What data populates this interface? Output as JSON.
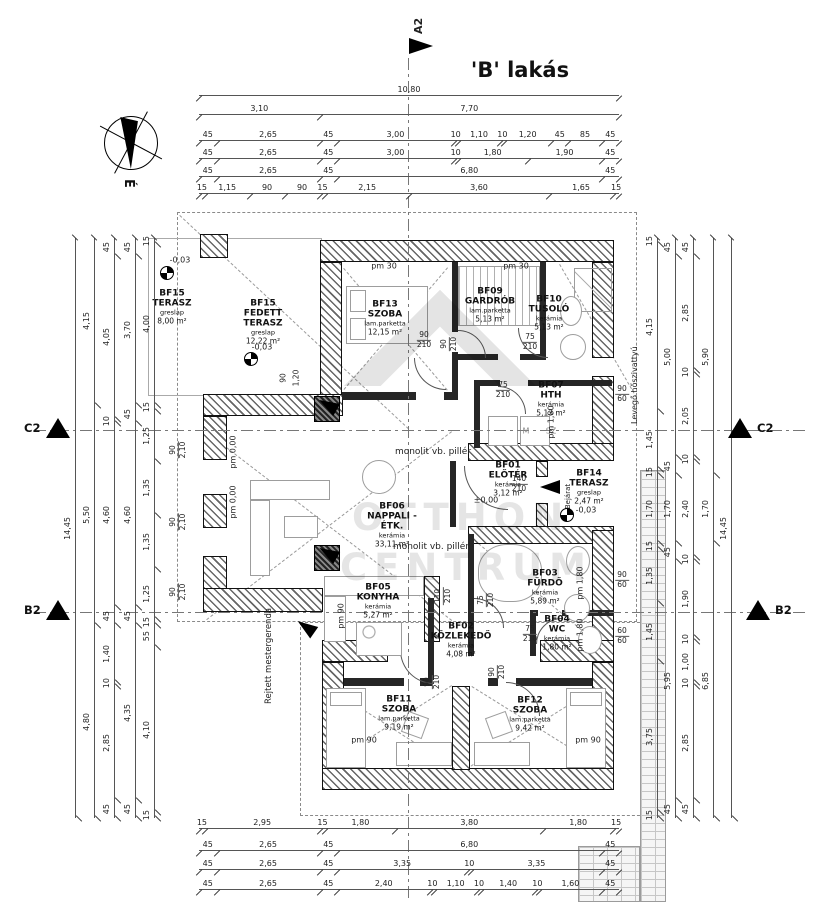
{
  "title": "'B' lakás",
  "markers": {
    "a2": "A2",
    "c2": "C2",
    "b2": "B2"
  },
  "compass": {
    "north_label": "É"
  },
  "watermark": {
    "line1": "OTTHON",
    "line2": "CENTRUM"
  },
  "rooms": [
    {
      "id": "BF15",
      "name": "TERASZ",
      "finish": "greslap",
      "area": "8,00 m²"
    },
    {
      "id": "BF15",
      "name": "FEDETT TERASZ",
      "finish": "greslap",
      "area": "12,22 m²"
    },
    {
      "id": "BF13",
      "name": "SZOBA",
      "finish": "lam.parketta",
      "area": "12,15 m²"
    },
    {
      "id": "BF09",
      "name": "GARDRÓB",
      "finish": "lam.parketta",
      "area": "5,13 m²"
    },
    {
      "id": "BF10",
      "name": "TUSOLÓ",
      "finish": "kerámia",
      "area": "5,13 m²"
    },
    {
      "id": "BF07",
      "name": "HTH",
      "finish": "kerámia",
      "area": "5,13 m²"
    },
    {
      "id": "BF01",
      "name": "ELŐTÉR",
      "finish": "kerámia",
      "area": "3,12 m²"
    },
    {
      "id": "BF14",
      "name": "TERASZ",
      "finish": "greslap",
      "area": "2,47 m²"
    },
    {
      "id": "BF06",
      "name": "NAPPALI - ÉTK.",
      "finish": "kerámia",
      "area": "33,11 m²"
    },
    {
      "id": "BF05",
      "name": "KONYHA",
      "finish": "kerámia",
      "area": "5,27 m²"
    },
    {
      "id": "BF02",
      "name": "KÖZLEKEDŐ",
      "finish": "kerámia",
      "area": "4,08 m²"
    },
    {
      "id": "BF03",
      "name": "FÜRDŐ",
      "finish": "kerámia",
      "area": "5,89 m²"
    },
    {
      "id": "BF04",
      "name": "WC",
      "finish": "kerámia",
      "area": "1,80 m²"
    },
    {
      "id": "BF11",
      "name": "SZOBA",
      "finish": "lam.parketta",
      "area": "9,19 m²"
    },
    {
      "id": "BF12",
      "name": "SZOBA",
      "finish": "lam.parketta",
      "area": "9,42 m²"
    }
  ],
  "annotations": {
    "pillar1": "monolit vb. pillér",
    "pillar2": "monolit vb. pillér",
    "hidden_beam": "Rejtett mestergerenda",
    "heat_pump": "Levegő hőszivattyú",
    "entrance": "'B' Bejárat",
    "washer": "M",
    "dryer": "SZ"
  },
  "text_labels": [
    {
      "text": "pm 30"
    },
    {
      "text": "pm 30"
    },
    {
      "text": "pm 90"
    },
    {
      "text": "pm 90"
    },
    {
      "text": "pm 90"
    },
    {
      "text": "pm 1,80"
    },
    {
      "text": "pm 1,80"
    },
    {
      "text": "pm 1,80"
    },
    {
      "text": "pm 0,00"
    },
    {
      "text": "pm 0,00"
    },
    {
      "text": "±0,00"
    },
    {
      "text": "-0,03"
    },
    {
      "text": "-0,03"
    },
    {
      "text": "-0,03"
    },
    {
      "text": "90"
    },
    {
      "text": "1,20"
    }
  ],
  "fraction_labels": [
    {
      "top": "90",
      "bottom": "210"
    },
    {
      "top": "90",
      "bottom": "210"
    },
    {
      "top": "75",
      "bottom": "210"
    },
    {
      "top": "75",
      "bottom": "210"
    },
    {
      "top": "140",
      "bottom": "210"
    },
    {
      "top": "110",
      "bottom": "210"
    },
    {
      "top": "75",
      "bottom": "210"
    },
    {
      "top": "75",
      "bottom": "210"
    },
    {
      "top": "90",
      "bottom": "210"
    },
    {
      "top": "90",
      "bottom": "210"
    },
    {
      "top": "90",
      "bottom": "2,10"
    },
    {
      "top": "90",
      "bottom": "2,10"
    },
    {
      "top": "90",
      "bottom": "2,10"
    },
    {
      "top": "90",
      "bottom": "60"
    },
    {
      "top": "90",
      "bottom": "60"
    },
    {
      "top": "60",
      "bottom": "60"
    }
  ],
  "dimensions": {
    "top": [
      [
        "10,80"
      ],
      [
        "3,10",
        "7,70"
      ],
      [
        "45",
        "2,65",
        "45",
        "3,00",
        "10",
        "1,10",
        "10",
        "1,20",
        "45",
        "85",
        "45"
      ],
      [
        "45",
        "2,65",
        "45",
        "3,00",
        "10",
        "1,80",
        "1,90",
        "45"
      ],
      [
        "45",
        "2,65",
        "45",
        "6,80",
        "45"
      ],
      [
        "15",
        "1,15",
        "90",
        "90",
        "15",
        "2,15",
        "3,60",
        "1,65",
        "15"
      ]
    ],
    "bottom": [
      [
        "15",
        "2,95",
        "15",
        "1,80",
        "3,80",
        "1,80",
        "15"
      ],
      [
        "45",
        "2,65",
        "45",
        "6,80",
        "45"
      ],
      [
        "45",
        "2,65",
        "45",
        "3,35",
        "10",
        "3,35",
        "45"
      ],
      [
        "45",
        "2,65",
        "45",
        "2,40",
        "10",
        "1,10",
        "10",
        "1,40",
        "10",
        "1,60",
        "45"
      ]
    ],
    "left": [
      [
        "14,45"
      ],
      [
        "4,15",
        "5,50",
        "4,80"
      ],
      [
        "45",
        "4,05",
        "10",
        "4,60",
        "45",
        "1,40",
        "10",
        "2,85",
        "45"
      ],
      [
        "45",
        "3,70",
        "45",
        "4,60",
        "45",
        "4,35",
        "45"
      ],
      [
        "15",
        "4,00",
        "15",
        "1,25",
        "1,35",
        "1,35",
        "1,25",
        "15",
        "55",
        "4,10",
        "15"
      ]
    ],
    "right": [
      [
        "15",
        "4,15",
        "1,45",
        "15",
        "1,70",
        "15",
        "1,35",
        "1,45",
        "3,75",
        "15"
      ],
      [
        "45",
        "5,00",
        "45",
        "1,70",
        "45",
        "5,95",
        "45"
      ],
      [
        "45",
        "2,85",
        "10",
        "2,05",
        "10",
        "2,40",
        "10",
        "1,90",
        "10",
        "1,00",
        "10",
        "2,85",
        "45"
      ],
      [
        "5,90",
        "1,70",
        "6,85"
      ],
      [
        "14,45"
      ]
    ]
  }
}
